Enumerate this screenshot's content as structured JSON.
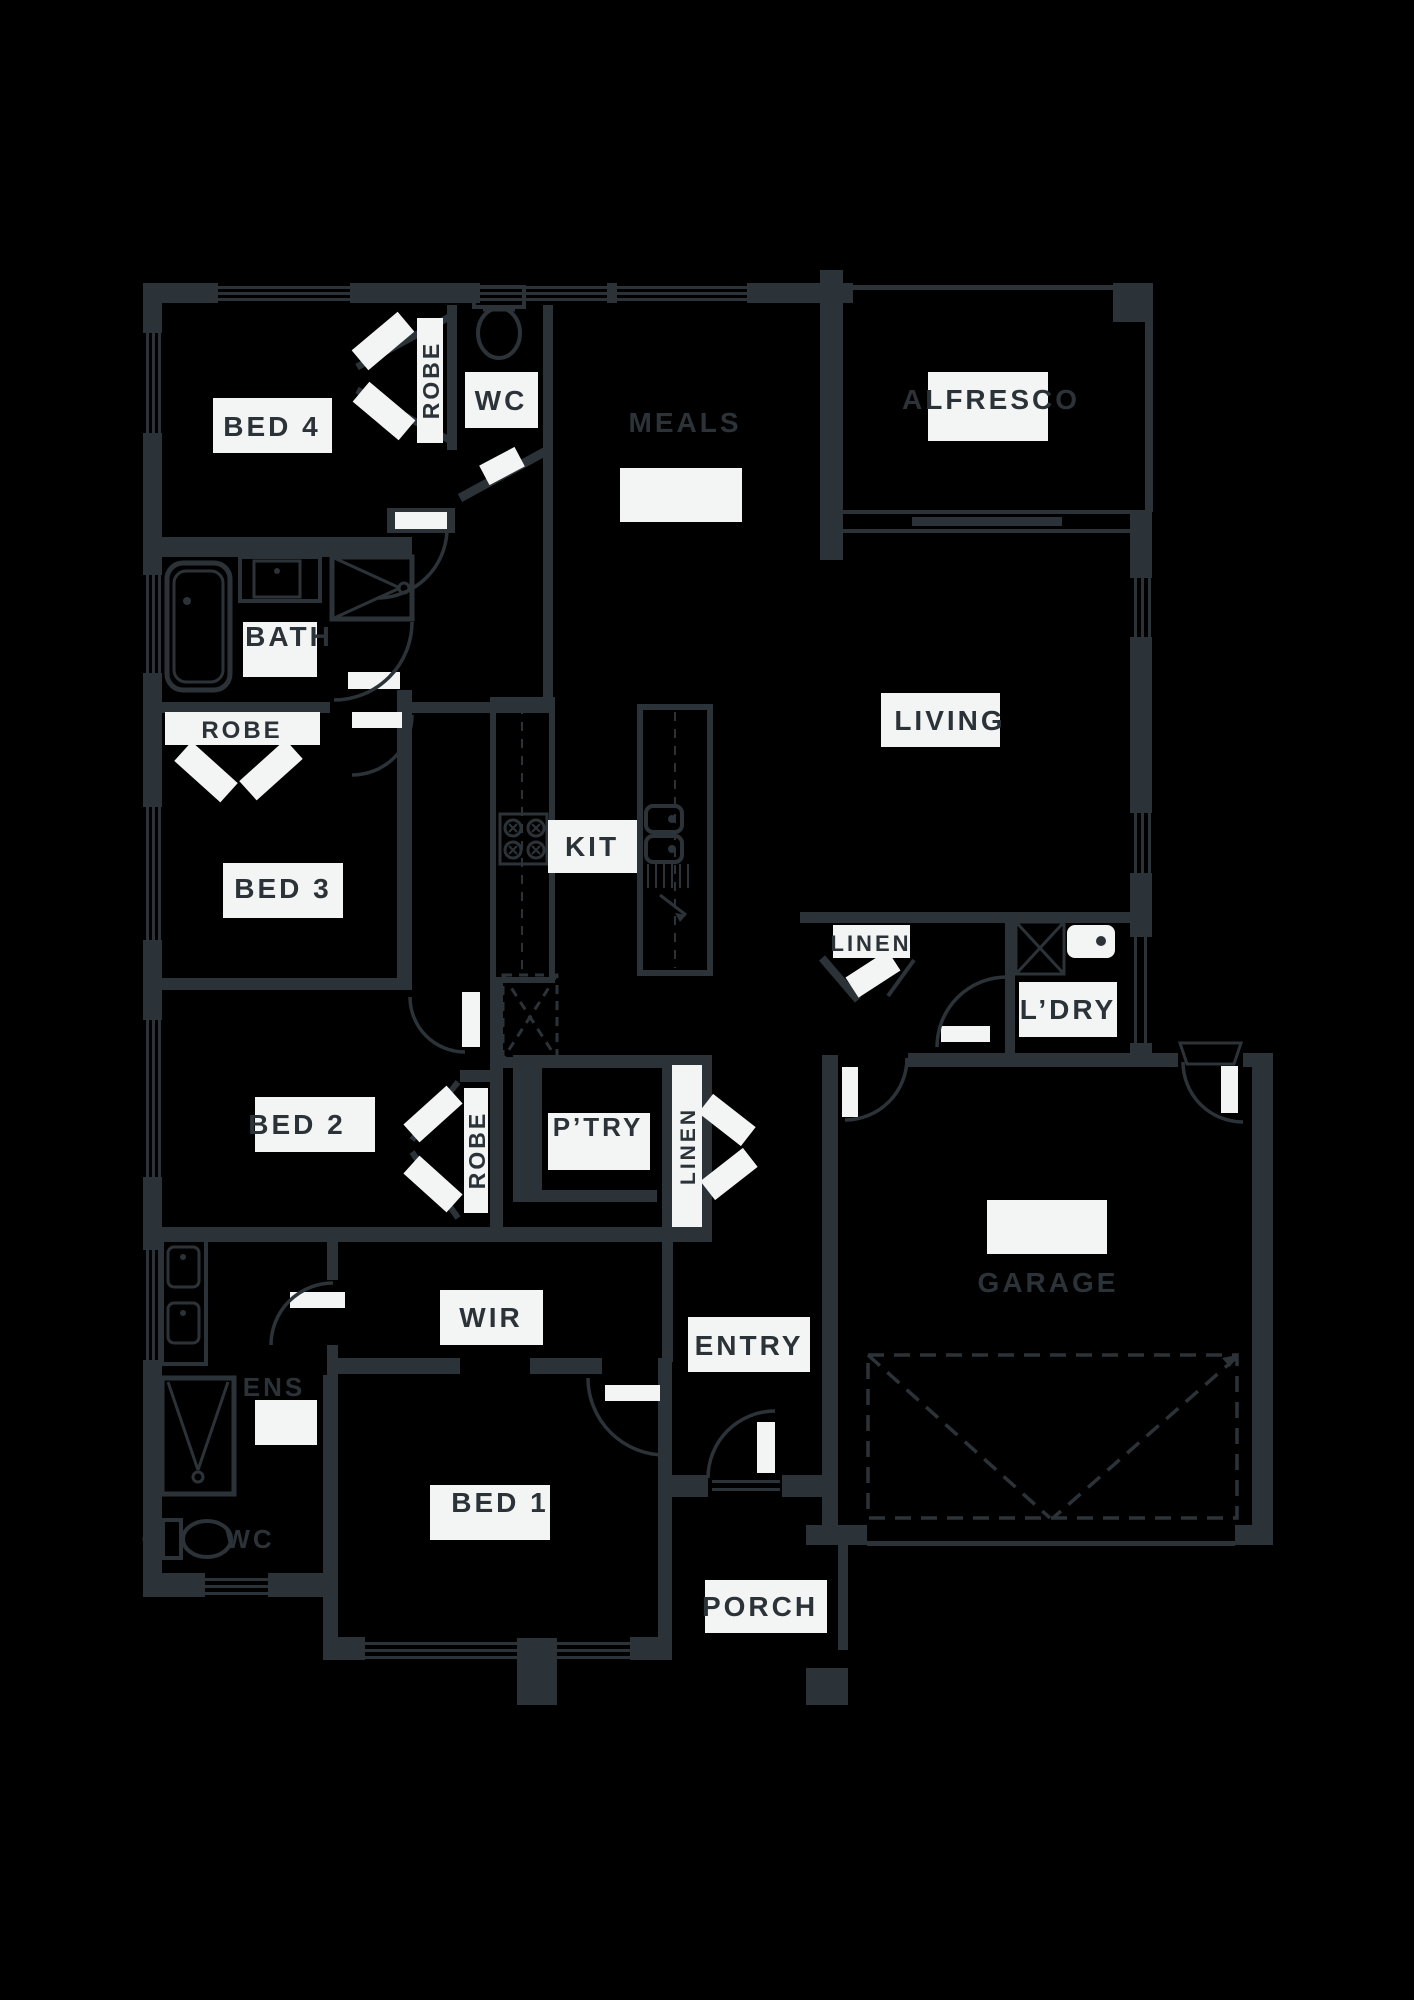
{
  "colors": {
    "background": "#000000",
    "wall": "#2c3338",
    "label_plate": "#f3f4f4",
    "label_text": "#2c3338"
  },
  "rooms": {
    "bed4": {
      "label": "BED 4"
    },
    "robe_bed4": {
      "label": "ROBE"
    },
    "wc_main": {
      "label": "WC"
    },
    "meals": {
      "label": "MEALS"
    },
    "alfresco": {
      "label": "ALFRESCO"
    },
    "bath": {
      "label": "BATH"
    },
    "robe_bed3": {
      "label": "ROBE"
    },
    "bed3": {
      "label": "BED 3"
    },
    "kitchen": {
      "label": "KIT"
    },
    "living": {
      "label": "LIVING"
    },
    "linen_hall": {
      "label": "LINEN"
    },
    "laundry": {
      "label": "L’DRY"
    },
    "bed2": {
      "label": "BED 2"
    },
    "robe_bed2": {
      "label": "ROBE"
    },
    "pantry": {
      "label": "P’TRY"
    },
    "linen_cupboard": {
      "label": "LINEN"
    },
    "wir": {
      "label": "WIR"
    },
    "entry": {
      "label": "ENTRY"
    },
    "garage": {
      "label": "GARAGE"
    },
    "ensuite": {
      "label": "ENS"
    },
    "wc_ensuite": {
      "label": "WC"
    },
    "bed1": {
      "label": "BED 1"
    },
    "porch": {
      "label": "PORCH"
    }
  }
}
